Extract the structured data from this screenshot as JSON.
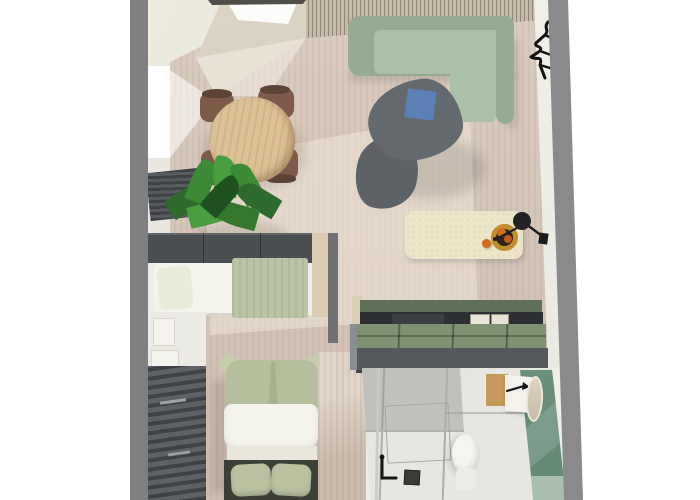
{
  "scene": {
    "type": "3d-top-view-floor-plan-render",
    "description": "Studio apartment rendered from above",
    "rooms": [
      "entry",
      "living-dining",
      "kitchen",
      "bedroom",
      "bathroom"
    ],
    "furniture": [
      "round dining table",
      "four wooden chairs",
      "L-shaped sofa",
      "two nesting coffee tables",
      "blue book",
      "abstract wall decor",
      "black wall lamp",
      "fruit bowl with oranges",
      "cream breakfast table",
      "kitchen counter with appliances",
      "tiled kitchen island",
      "potted plant",
      "dark sideboard",
      "daybed with pillow and throw",
      "two radiators",
      "double bed with green duvet and two pillows",
      "wardrobe",
      "walk-in shower with drain",
      "toilet",
      "vanity with sink and oval mirror",
      "window",
      "entry door",
      "skylight"
    ]
  },
  "palette": {
    "floor": "#d6c5b8",
    "wall_exterior": "#828285",
    "wall_interior": "#edebe4",
    "slat_wall": "#c7bba7",
    "sofa": "#abc0a8",
    "sofa_dark": "#95ab92",
    "coffee_table": "#64696d",
    "book_blue": "#5b80b5",
    "dining_table": "#dcc197",
    "chair": "#7d5a4a",
    "plant_green": "#3c8a36",
    "cabinet_dark": "#4b4f52",
    "mattress_white": "#f4f3ec",
    "pillow_pale": "#e9ecd9",
    "throw_green": "#bac4a4",
    "duvet_green": "#b6bf9d",
    "bed_pillow": "#b9c1a1",
    "bed_base": "#3c3f35",
    "wardrobe_wood": "#d8c7b6",
    "counter_back_green": "#5f6f58",
    "kitchen_dark": "#2c3033",
    "island_green": "#7e9171",
    "island_front": "#54585c",
    "table_cream": "#ece5c7",
    "bowl_gold": "#c08f2d",
    "orange": "#d2691e",
    "bath_tile": "#c9c8c4",
    "toilet_white": "#f5f4f0",
    "vanity_wood": "#c59a5c",
    "bath_green": "#7ba390",
    "mirror_beige": "#d3c7b4",
    "fixture_black": "#1c1c1c",
    "window_white": "#ffffff"
  }
}
